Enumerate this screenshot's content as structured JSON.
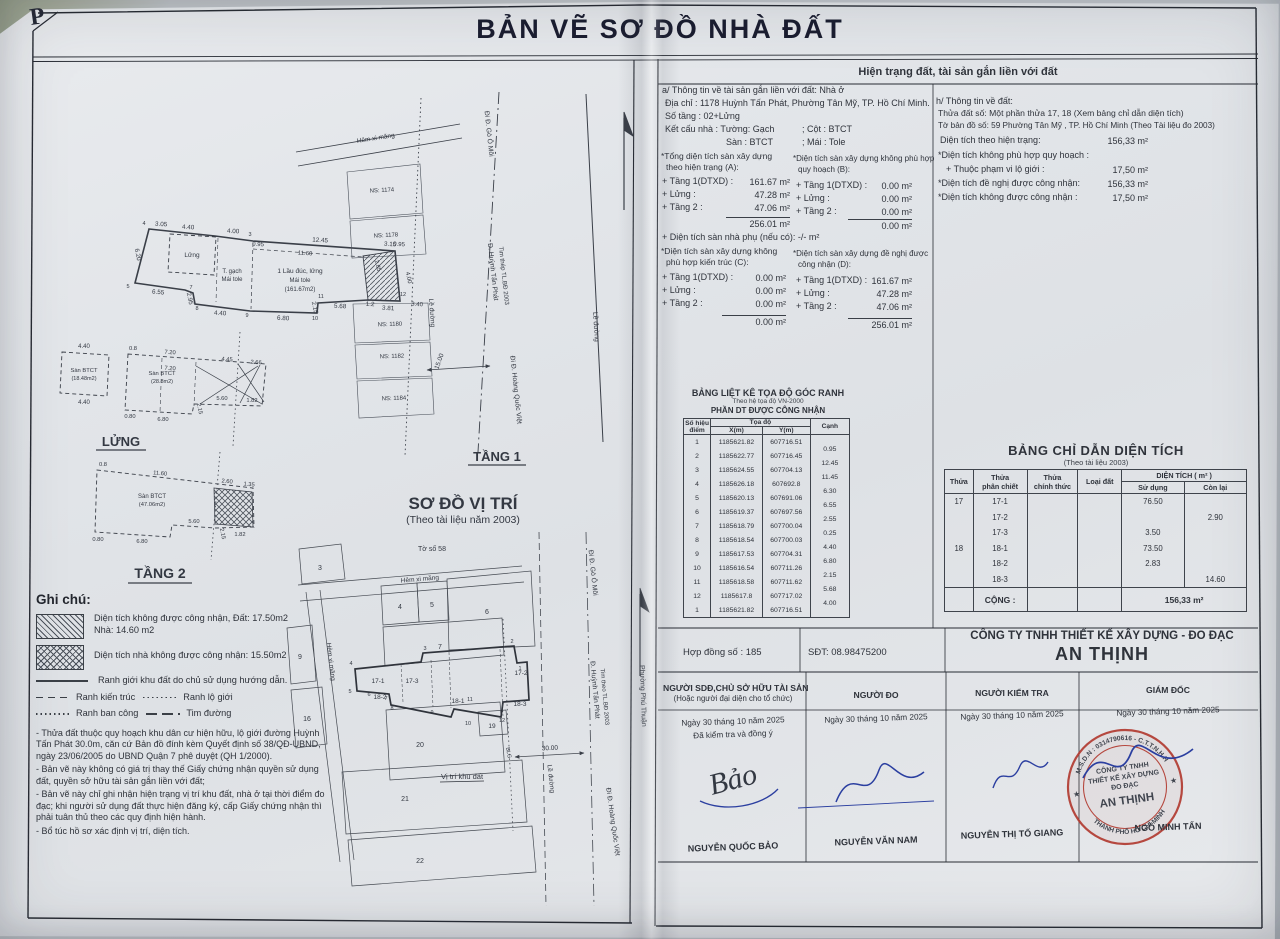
{
  "page": {
    "corner_mark": "P",
    "title": "BẢN VẼ  SƠ ĐỒ NHÀ ĐẤT"
  },
  "info": {
    "header": "Hiện trạng đất, tài sản gắn liền với đất",
    "asset": {
      "heading": "a/ Thông tin về tài sản gắn liền với đất: Nhà ở",
      "address": "Địa chỉ : 1178 Huỳnh Tấn Phát, Phường Tân Mỹ, TP. Hồ Chí Minh.",
      "floors": "Số tầng : 02+Lửng",
      "structure": "Kết cấu nhà : Tường:  Gạch",
      "col": "; Cột :  BTCT",
      "floor": "Sàn :  BTCT",
      "roof": "; Mái :  Tole",
      "a_head1": "*Tổng diện tích sàn xây dựng",
      "a_head2": "theo hiện trạng (A):",
      "b_head1": "*Diện tích sàn xây dựng không phù hợp",
      "b_head2": "quy hoạch (B):",
      "rows_label": [
        "+ Tầng 1(DTXD) :",
        "+ Lửng :",
        "+ Tầng 2 :"
      ],
      "a_values": [
        "161.67 m²",
        "47.28 m²",
        "47.06 m²"
      ],
      "a_total": "256.01 m²",
      "b_values": [
        "0.00 m²",
        "0.00 m²",
        "0.00 m²"
      ],
      "b_total": "0.00 m²",
      "phu": "+ Diện tích sàn nhà phụ (nếu có): -/- m²",
      "c_head1": "*Diện tích sàn xây dựng không",
      "c_head2": "phù hợp kiến trúc (C):",
      "d_head1": "*Diện tích sàn xây dựng đề nghị được",
      "d_head2": "công nhận (D):",
      "c_values": [
        "0.00 m²",
        "0.00 m²",
        "0.00 m²"
      ],
      "c_total": "0.00 m²",
      "d_values": [
        "161.67 m²",
        "47.28 m²",
        "47.06 m²"
      ],
      "d_total": "256.01 m²"
    },
    "land": {
      "heading": "h/ Thông tin về đất:",
      "plot": "Thửa đất số:  Một phần thửa 17, 18  (Xem bảng chỉ dẫn diện tích)",
      "sheet": "Tờ bản đồ số:  59  Phường Tân Mỹ , TP. Hồ Chí Minh (Theo Tài liệu đo 2003)",
      "rows": [
        {
          "label": "Diện tích theo hiện trạng:",
          "value": "156,33 m²"
        },
        {
          "label": "*Diện tích không phù hợp quy hoạch :",
          "value": ""
        },
        {
          "label": "+ Thuộc phạm vi lộ giới :",
          "value": "17,50 m²"
        },
        {
          "label": "*Diện tích đề nghị được công nhận:",
          "value": "156,33 m²"
        },
        {
          "label": "*Diện tích không được công nhận :",
          "value": "17,50 m²"
        }
      ]
    }
  },
  "coord_table": {
    "title": "BẢNG LIỆT KÊ TỌA ĐỘ GÓC RANH",
    "sub": "Theo hệ tọa độ VN-2000",
    "section": "PHẦN DT ĐƯỢC CÔNG NHẬN",
    "h_point": "Số hiệu",
    "h_point2": "điểm",
    "h_coord": "Tọa độ",
    "h_x": "X(m)",
    "h_y": "Y(m)",
    "h_edge": "Cạnh",
    "rows": [
      {
        "p": "1",
        "x": "1185621.82",
        "y": "607716.51",
        "c": "0.95"
      },
      {
        "p": "2",
        "x": "1185622.77",
        "y": "607716.45",
        "c": "12.45"
      },
      {
        "p": "3",
        "x": "1185624.55",
        "y": "607704.13",
        "c": "11.45"
      },
      {
        "p": "4",
        "x": "1185626.18",
        "y": "607692.8",
        "c": "6.30"
      },
      {
        "p": "5",
        "x": "1185620.13",
        "y": "607691.06",
        "c": "6.55"
      },
      {
        "p": "6",
        "x": "1185619.37",
        "y": "607697.56",
        "c": "2.55"
      },
      {
        "p": "7",
        "x": "1185618.79",
        "y": "607700.04",
        "c": "0.25"
      },
      {
        "p": "8",
        "x": "1185618.54",
        "y": "607700.03",
        "c": "4.40"
      },
      {
        "p": "9",
        "x": "1185617.53",
        "y": "607704.31",
        "c": "6.80"
      },
      {
        "p": "10",
        "x": "1185616.54",
        "y": "607711.26",
        "c": "2.15"
      },
      {
        "p": "11",
        "x": "1185618.58",
        "y": "607711.62",
        "c": "5.68"
      },
      {
        "p": "12",
        "x": "1185617.8",
        "y": "607717.02",
        "c": "4.00"
      },
      {
        "p": "1",
        "x": "1185621.82",
        "y": "607716.51",
        "c": ""
      }
    ]
  },
  "area_table": {
    "title": "BẢNG CHỈ DẪN DIỆN TÍCH",
    "sub": "(Theo tài liệu 2003)",
    "h_thua": "Thửa",
    "h_pc1": "Thửa",
    "h_pc2": "phân chiết",
    "h_ct1": "Thửa",
    "h_ct2": "chính thức",
    "h_ld": "Loại đất",
    "h_dt": "DIỆN TÍCH ( m² )",
    "h_sd": "Sử dụng",
    "h_cl": "Còn lại",
    "rows": [
      {
        "thua": "17",
        "pc": "17-1",
        "sd": "76.50",
        "cl": ""
      },
      {
        "thua": "",
        "pc": "17-2",
        "sd": "",
        "cl": "2.90"
      },
      {
        "thua": "",
        "pc": "17-3",
        "sd": "3.50",
        "cl": ""
      },
      {
        "thua": "18",
        "pc": "18-1",
        "sd": "73.50",
        "cl": ""
      },
      {
        "thua": "",
        "pc": "18-2",
        "sd": "2.83",
        "cl": ""
      },
      {
        "thua": "",
        "pc": "18-3",
        "sd": "",
        "cl": "14.60"
      }
    ],
    "total_label": "CỘNG  :",
    "total_value": "156,33 m²"
  },
  "company": {
    "contract": "Hợp đồng số : 185",
    "phone": "SĐT: 08.98475200",
    "name1": "CÔNG TY TNHH THIẾT KẾ XÂY DỰNG - ĐO ĐẠC",
    "name2": "AN THỊNH"
  },
  "signatures": {
    "cols": [
      {
        "role": "NGƯỜI SDĐ,CHỦ SỞ HỮU TÀI SẢN",
        "role2": "(Hoặc người đại diện cho tổ chức)",
        "date": "Ngày 30 tháng 10 năm 2025",
        "note": "Đã kiểm tra và đồng ý",
        "name": "NGUYỄN QUỐC BẢO"
      },
      {
        "role": "NGƯỜI ĐO",
        "date": "Ngày 30 tháng 10 năm 2025",
        "name": "NGUYỄN VĂN NAM"
      },
      {
        "role": "NGƯỜI KIỂM TRA",
        "date": "Ngày 30 tháng 10 năm 2025",
        "name": "NGUYỄN THỊ TỐ GIANG"
      },
      {
        "role": "GIÁM ĐỐC",
        "date": "Ngày 30 tháng 10 năm 2025",
        "name": "NGÔ MINH TẤN"
      }
    ],
    "handsign1": "Bảo"
  },
  "stamp": {
    "ring_top": "M.S.D.N : 0314790616 - C.T.T.N.H.H",
    "ring_bottom": "THÀNH PHỐ HỒ CHÍ MINH",
    "star": "★",
    "line1": "CÔNG TY TNHH",
    "line2": "THIẾT KẾ XÂY DỰNG",
    "line3": "ĐO ĐẠC",
    "line4": "AN THỊNH"
  },
  "ghichu": {
    "heading": "Ghi chú:",
    "legend1a": "Diện tích không được công nhận, Đất: 17.50m2",
    "legend1b": "Nhà: 14.60 m2",
    "legend2": "Diện tích nhà không được công nhận: 15.50m2",
    "legend3": "Ranh giới khu đất do chủ sử dụng hướng dẫn.",
    "legend4a": "Ranh kiến trúc",
    "legend4b": "Ranh lộ giới",
    "legend5a": "Ranh ban công",
    "legend5b": "Tim đường",
    "notes": [
      "- Thửa đất thuộc quy hoạch khu dân cư hiện hữu, lộ giới đường Huỳnh Tấn Phát 30.0m, căn cứ Bản đồ đính kèm Quyết định số 38/QĐ-UBND, ngày 23/06/2005 do UBND Quận 7 phê duyệt (QH 1/2000).",
      "- Bản vẽ này không có giá trị thay thế Giấy chứng nhận quyền sử dụng đất, quyền sở hữu tài sản gắn liền với đất;",
      "- Bản vẽ này chỉ ghi nhận hiện trạng vị trí khu đất, nhà ở tại thời điểm đo đạc; khi người sử dụng đất thực hiện đăng ký, cấp Giấy chứng nhận thì phải tuân thủ theo các quy định hiện hành.",
      "- Bổ túc hồ sơ xác định vị trí, diện tích."
    ]
  },
  "plan1": {
    "label": "TẦNG 1",
    "alley": "Hẻm xi măng",
    "ns": [
      "NS: 1174",
      "NS: 1178",
      "NS: 1180",
      "NS: 1182",
      "NS: 1184"
    ],
    "inner": [
      "Lửng",
      "T. gạch",
      "Mái tole",
      "1 Lầu đúc, lửng",
      "Mái tole",
      "(161.67m2)"
    ],
    "points": [
      "4",
      "3",
      "5",
      "7",
      "8",
      "9",
      "10",
      "11",
      "12"
    ],
    "dims_top": [
      "3.05",
      "4.40",
      "4.00",
      "12.45",
      "3.15"
    ],
    "dims_left": [
      "6.20"
    ],
    "dims_bottom": [
      "6.55",
      "2.95",
      "4.40",
      "6.80",
      "2.15",
      "5.68",
      "1.2",
      "3.81"
    ],
    "dims_right": [
      "2.85",
      "0.95",
      "4.00",
      "3.40"
    ],
    "dims_inner": [
      "0.95",
      "11.60"
    ],
    "roads": {
      "go_o_moi": "Đi Đ. Gò Ô Môi",
      "main": "Đ. Huỳnh Tấn Phát",
      "main2": "Tim thép TL.BĐ 2003",
      "hqv": "Đi Đ. Hoàng Quốc Việt",
      "le_duong": "Lề đường",
      "le_duong2": "Lề đường",
      "dim": "15.00"
    }
  },
  "lung": {
    "label": "LỬNG",
    "box1": [
      "Sàn BTCT",
      "(18.48m2)"
    ],
    "box1_dims": [
      "4.40",
      "4.40"
    ],
    "box2": [
      "Sàn BTCT",
      "(28.8m2)"
    ],
    "dims": [
      "0.8",
      "7.20",
      "4.45",
      "2.66",
      "7.20",
      "5.60",
      "1.82",
      "2.15",
      "0.80",
      "6.80"
    ]
  },
  "tang2": {
    "label": "TẦNG 2",
    "box": [
      "Sàn BTCT",
      "(47.06m2)"
    ],
    "dims": [
      "0.8",
      "11.60",
      "2.60",
      "1.35",
      "5.60",
      "1.82",
      "2.15",
      "0.80",
      "6.80"
    ]
  },
  "vitri": {
    "title": "SƠ ĐỒ VỊ TRÍ",
    "sub": "(Theo tài liệu năm 2003)",
    "sheet": "Tờ số 58",
    "alley1": "Hẻm xi măng",
    "alley2": "Hẻm xi măng",
    "site": "Vị trí khu đất",
    "parcels": [
      "3",
      "4",
      "5",
      "6",
      "7",
      "9",
      "16",
      "20",
      "21",
      "22",
      "19",
      "17-1",
      "17-2",
      "17-3",
      "18-1",
      "18-2",
      "18-3"
    ],
    "points": [
      "1",
      "2",
      "3",
      "4",
      "5",
      "6",
      "7",
      "8",
      "9",
      "10",
      "11",
      "12"
    ],
    "roads": {
      "go_o_moi": "Đi Đ. Gò Ô Môi",
      "main": "Đ. Huỳnh Tấn Phát",
      "main2": "Tim theo TL.BĐ 2003",
      "hqv": "Đi Đ. Hoàng Quốc Việt",
      "le_duong": "Lề đường",
      "phuong": "Phường Phú Thuận",
      "blg": "BLG",
      "dim": "30.00"
    }
  }
}
